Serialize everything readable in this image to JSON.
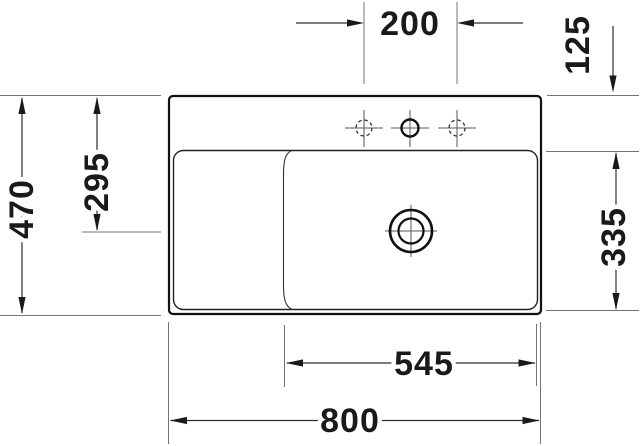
{
  "drawing": {
    "type": "technical-dimension-drawing",
    "subject": "washbasin top view",
    "unit": "mm",
    "dims": {
      "tap_spacing": "200",
      "rear_offset": "125",
      "depth_overall": "470",
      "depth_drain": "295",
      "bowl_depth": "335",
      "bowl_width": "545",
      "width_overall": "800"
    },
    "colors": {
      "background": "#ffffff",
      "outline": "#111111",
      "dimension_line": "#2e2e2e",
      "extension_line": "#747474",
      "label_text": "#1a1a1a"
    },
    "features": {
      "tap_holes": [
        "left-optional-dashed",
        "center-solid",
        "right-optional-dashed"
      ],
      "drain": "center-of-bowl"
    }
  }
}
